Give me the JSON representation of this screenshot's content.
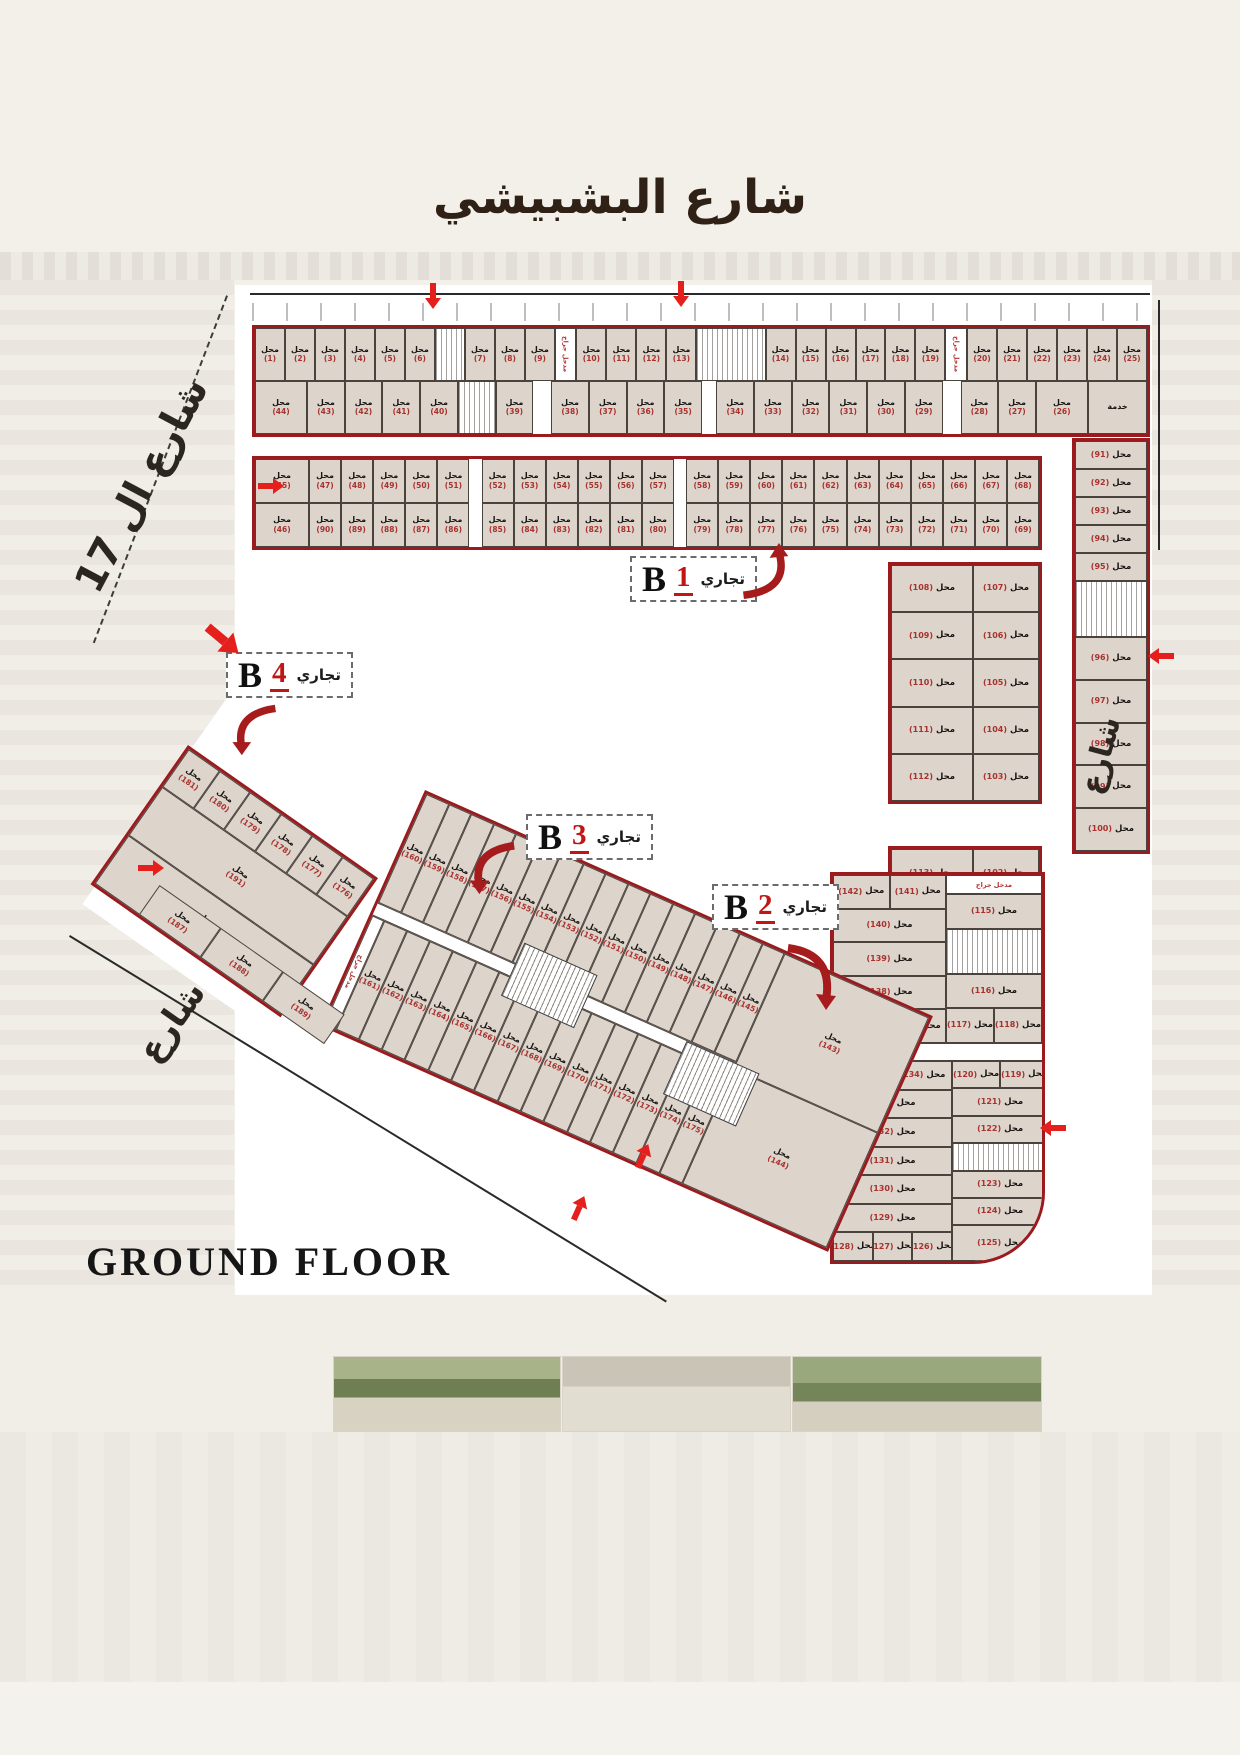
{
  "page": {
    "street_top": "شارع البشبيشي",
    "street_left": "شارع ال 17",
    "street_left_lower": "شارع",
    "street_right": "شارع",
    "floor_label": "GROUND FLOOR"
  },
  "labels": {
    "shop": "محل",
    "service": "خدمة",
    "garage_entrance": "مدخل جراج",
    "commercial": "تجاري"
  },
  "colors": {
    "block_border": "#9a1a1e",
    "arrow_red": "#e41f1c",
    "shop_number_red": "#a8322e",
    "shop_fill": "#ddd4cc",
    "title_ink": "#2f2115"
  },
  "blocks": {
    "b1": {
      "letter": "B",
      "number": "1",
      "type": "تجاري"
    },
    "b2": {
      "letter": "B",
      "number": "2",
      "type": "تجاري"
    },
    "b3": {
      "letter": "B",
      "number": "3",
      "type": "تجاري"
    },
    "b4": {
      "letter": "B",
      "number": "4",
      "type": "تجاري"
    }
  },
  "strips": {
    "b1_row_a": {
      "dir": "h",
      "cells": [
        "1-6",
        "core",
        "7-9",
        "grg:0.7",
        "10-13",
        "core:2.4",
        "14-19",
        "grg:0.7",
        "20-25"
      ]
    },
    "b1_row_b": {
      "dir": "h",
      "cells": [
        "44:1.4",
        "43-40",
        "core",
        "39",
        "gap:0.5",
        "38-35",
        "gap:0.4",
        "34-29",
        "gap:0.5",
        "28-27",
        "26:1.4",
        "svc:1.6"
      ]
    },
    "b1_col_left": {
      "dir": "v",
      "cells": [
        "45",
        "46"
      ]
    },
    "b1_row_c": {
      "dir": "h",
      "cells": [
        "47-51",
        "gap:0.4",
        "52-57",
        "gap:0.4",
        "58-68"
      ]
    },
    "b1_row_d": {
      "dir": "h",
      "cells": [
        "90-86",
        "gap:0.4",
        "85-80",
        "gap:0.4",
        "79-69"
      ]
    },
    "b1_col_91": {
      "dir": "v",
      "inline": true,
      "cells": [
        "91-95"
      ]
    },
    "b1_col_96": {
      "dir": "v",
      "inline": true,
      "cells": [
        "96-100"
      ]
    },
    "b1_wing_upper": {
      "dir": "v",
      "inline": true,
      "cells": [
        "108:1.25|107",
        "109:1.25|106",
        "110:1.25|105",
        "111:1.25|104",
        "112:1.25|103"
      ]
    },
    "b1_wing_lower": {
      "dir": "v",
      "inline": true,
      "cells": [
        "113:1.25|102",
        "114:1.25|101"
      ]
    },
    "b2_top_left": {
      "dir": "v",
      "inline": true,
      "cells": [
        "142|141",
        "140",
        "139",
        "138",
        "136|137"
      ]
    },
    "b2_top_right": {
      "dir": "v",
      "inline": true,
      "cells": [
        "grgh:0.55",
        "115",
        "core:1.3",
        "116",
        "117|118"
      ]
    },
    "b2_bot_left": {
      "dir": "v",
      "inline": true,
      "cells": [
        "135|134",
        "133",
        "132",
        "131",
        "130",
        "129",
        "128|127|126"
      ]
    },
    "b2_bot_right": {
      "dir": "v",
      "inline": true,
      "cells": [
        "120|119",
        "121",
        "122",
        "core",
        "123",
        "124",
        "125:1.3"
      ]
    },
    "b3_row_top": {
      "dir": "h",
      "cells": [
        "160-145"
      ]
    },
    "b3_tip": {
      "dir": "v",
      "cells": [
        "143",
        "144"
      ]
    },
    "b3_row_bottom": {
      "dir": "h",
      "cells": [
        "grg:0.45",
        "161-175"
      ]
    },
    "b4_row_top": {
      "dir": "h",
      "cells": [
        "181-176"
      ]
    },
    "b4_col_left": {
      "dir": "v",
      "cells": [
        "182-186"
      ]
    },
    "b4_col_right": {
      "dir": "v",
      "cells": [
        "191",
        "190"
      ]
    },
    "b4_row_bottom": {
      "dir": "h",
      "cells": [
        "187-189"
      ]
    }
  }
}
